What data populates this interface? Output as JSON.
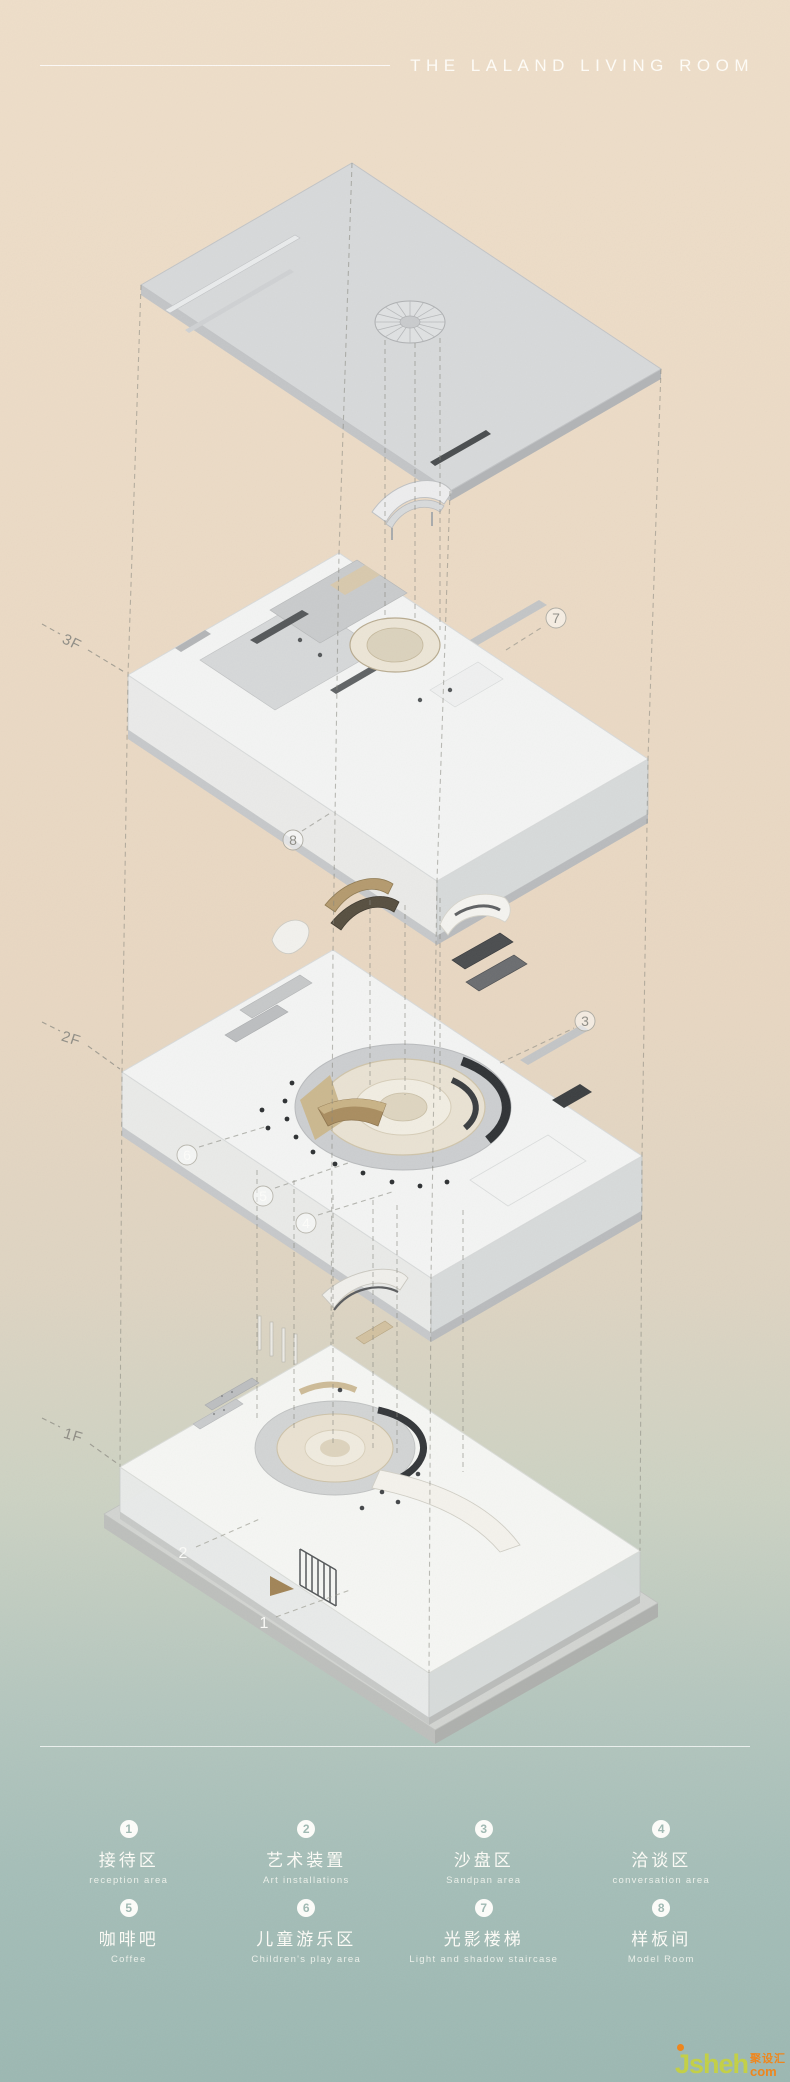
{
  "header": {
    "title": "THE LALAND LIVING ROOM"
  },
  "floors": {
    "f3": "3F",
    "f2": "2F",
    "f1": "1F"
  },
  "callouts": {
    "labels": [
      "1",
      "2",
      "3",
      "4",
      "5",
      "6",
      "7",
      "8"
    ]
  },
  "legend": {
    "items": [
      {
        "num": "1",
        "zh": "接待区",
        "en": "reception area"
      },
      {
        "num": "2",
        "zh": "艺术装置",
        "en": "Art installations"
      },
      {
        "num": "3",
        "zh": "沙盘区",
        "en": "Sandpan area"
      },
      {
        "num": "4",
        "zh": "洽谈区",
        "en": "conversation area"
      },
      {
        "num": "5",
        "zh": "咖啡吧",
        "en": "Coffee"
      },
      {
        "num": "6",
        "zh": "儿童游乐区",
        "en": "Children's play area"
      },
      {
        "num": "7",
        "zh": "光影楼梯",
        "en": "Light and shadow staircase"
      },
      {
        "num": "8",
        "zh": "样板间",
        "en": "Model Room"
      }
    ]
  },
  "watermark": {
    "site": "Jsheh",
    "cn": "聚设汇",
    "tld": "com"
  },
  "colors": {
    "background_top": "#eedec9",
    "background_bottom": "#9cb8b2",
    "title_text": "#fffdf8",
    "roof": "#d7d9da",
    "floor_top": "#f3f4f3",
    "accent_tan": "#cdbb9a",
    "accent_dark": "#3a3d3f",
    "watermark_green": "#c3d045",
    "watermark_orange": "#f08519"
  }
}
